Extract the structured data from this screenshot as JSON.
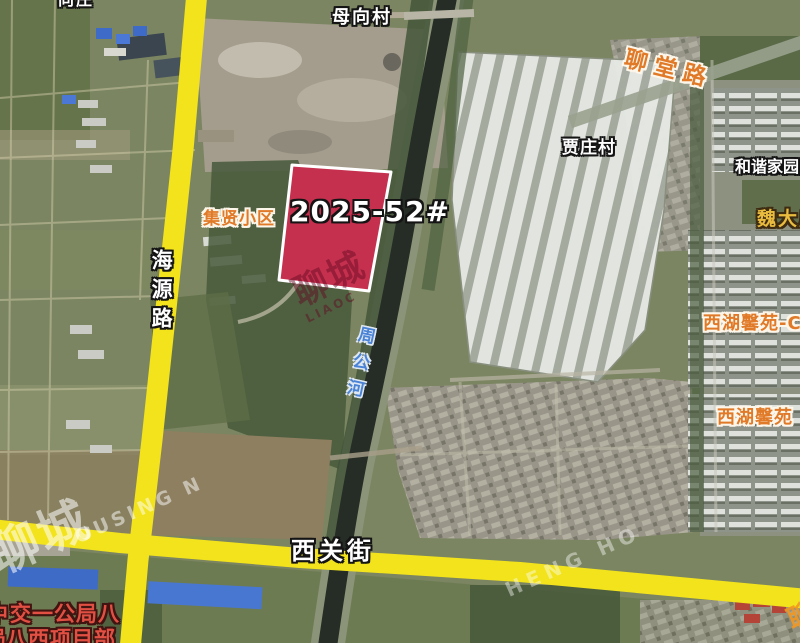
{
  "map": {
    "kind": "satellite-parcel-annotation-map",
    "parcel": {
      "id": "2025-52#",
      "fill_color": "#c5304e",
      "border_color": "#ffffff"
    },
    "roads": {
      "haiyuan": {
        "name": "海源路",
        "highlight_color": "#f2e31d"
      },
      "xiguan": {
        "name": "西关街",
        "highlight_color": "#f2e31d"
      },
      "liaotang": {
        "name": "聊堂路",
        "label_color": "#e07a28"
      }
    },
    "river": {
      "name": "周公河",
      "label_color": "#4a82d6"
    },
    "places": {
      "top_left_partial": "向庄",
      "muxiangcun": "母向村",
      "jiazhuangcun": "贾庄村",
      "hexie_jiayuan": "和谐家园",
      "weidamiao": "魏大庙",
      "xihu_xinyuan_c": "西湖馨苑-C",
      "xihu_xinyuan": "西湖馨苑",
      "jixian_xiaoqu": "集贤小区"
    },
    "annotations": {
      "project_line1_prefix": "中",
      "project_line1": "交一公局八",
      "project_line2_prefix": "局",
      "project_line2": "八西项目部"
    },
    "watermarks": {
      "parcel_cn": "聊城",
      "parcel_en": "LIAOC",
      "bottom_left_cn": "聊城",
      "bottom_left_en": "OUSING N",
      "road_en": "HENG HO",
      "bottom_right_cn": "聊城"
    },
    "colors": {
      "road_highlight_yellow": "#f2e31d",
      "parcel_red": "#c5304e",
      "canal_water": "#262d26",
      "field_green": "#7b8561",
      "tree_green": "#44563a",
      "warehouse_roof": "#e6e9e4"
    }
  }
}
